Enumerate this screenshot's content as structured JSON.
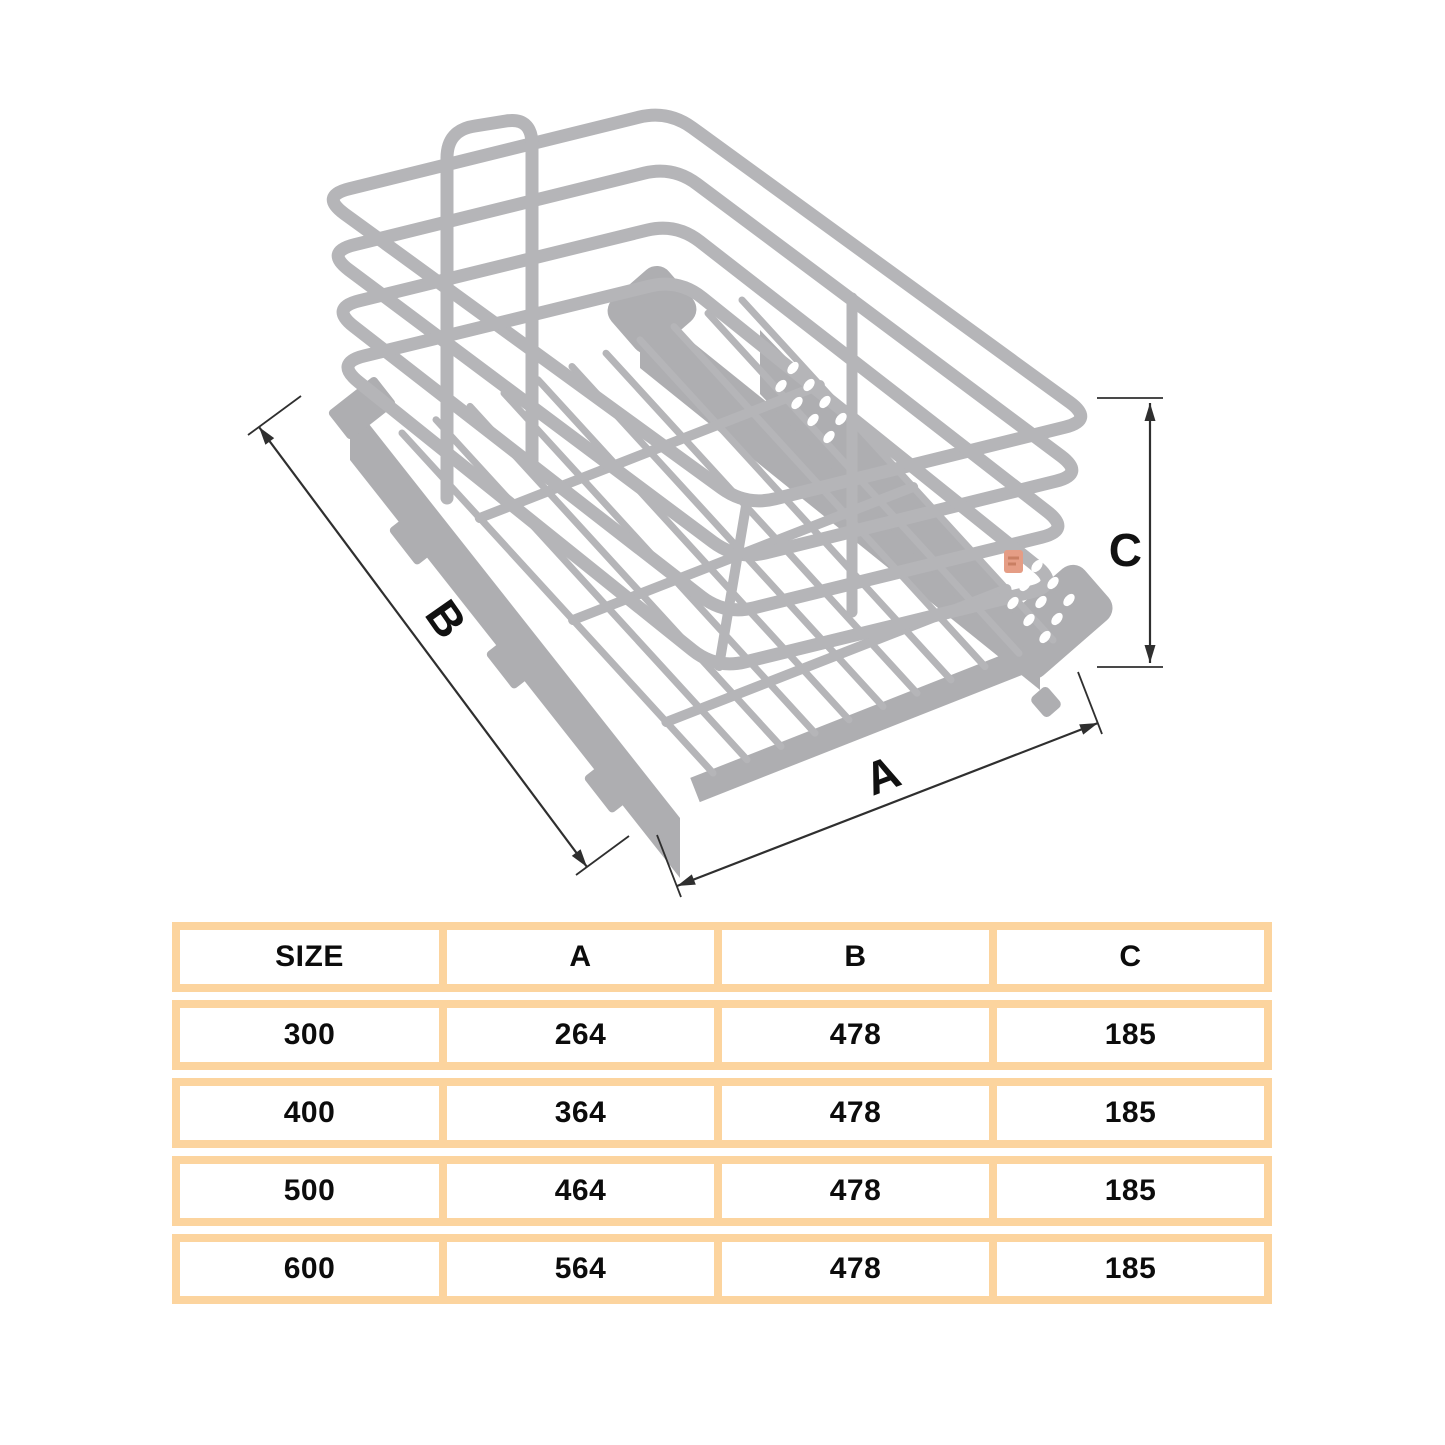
{
  "figure": {
    "description": "Isometric line drawing of pull-out wire storage basket with telescopic runners",
    "labels": {
      "width": "A",
      "depth": "B",
      "height": "C"
    }
  },
  "table": {
    "headers": [
      "SIZE",
      "A",
      "B",
      "C"
    ],
    "rows": [
      [
        "300",
        "264",
        "478",
        "185"
      ],
      [
        "400",
        "364",
        "478",
        "185"
      ],
      [
        "500",
        "464",
        "478",
        "185"
      ],
      [
        "600",
        "564",
        "478",
        "185"
      ]
    ]
  },
  "colors": {
    "wire_gray": "#b5b5b8",
    "chassis_gray": "#aeaeb1",
    "dimension_line": "#2f2f2f",
    "table_border": "#fcd49e",
    "logo_orange": "#e59d85",
    "text": "#0c0c0c",
    "background": "#ffffff"
  }
}
